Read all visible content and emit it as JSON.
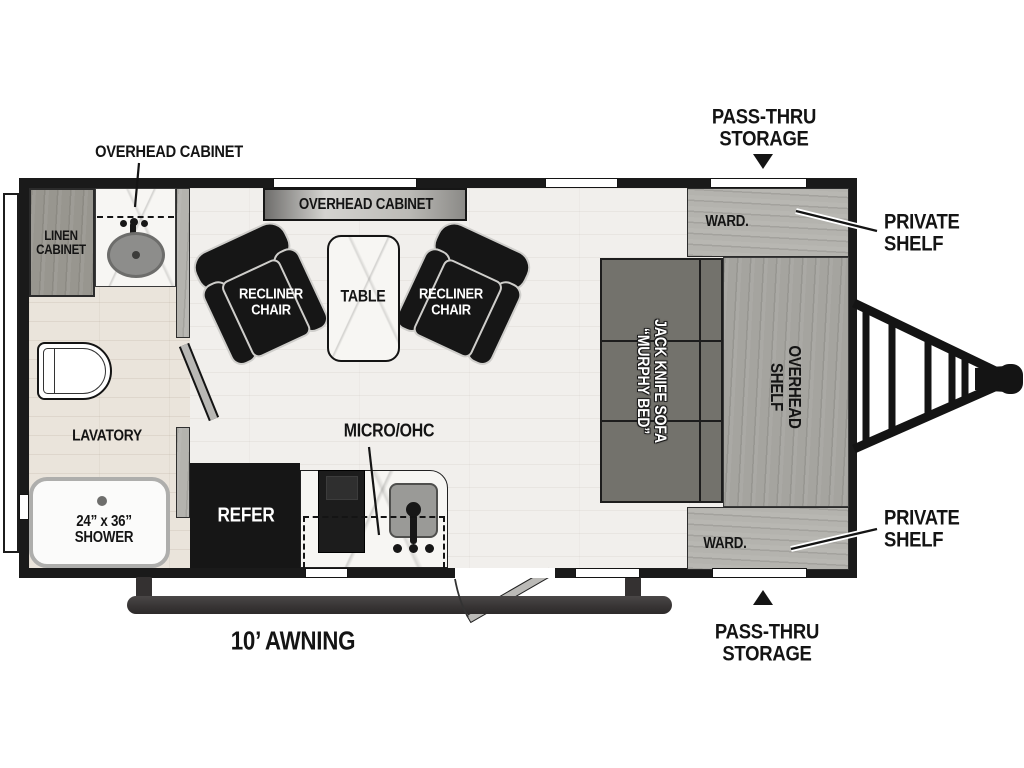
{
  "title": "Travel trailer floorplan",
  "colors": {
    "wall": "#1a1a1a",
    "floor-main": "#f1efec",
    "floor-bath": "#eae4db",
    "wood-light": "#b4b3ae",
    "wood-mid": "#a5a49f",
    "wood-dark": "#98968f",
    "black-furn": "#161616",
    "sofa": "#73726c",
    "marble": "#f7f6f3",
    "awning": "#3e3b3b"
  },
  "labels": {
    "overhead_cabinet_callout": "OVERHEAD CABINET",
    "pass_thru_top": {
      "line1": "PASS-THRU",
      "line2": "STORAGE"
    },
    "private_shelf_top": {
      "line1": "PRIVATE",
      "line2": "SHELF"
    },
    "linen_cabinet": {
      "line1": "LINEN",
      "line2": "CABINET"
    },
    "overhead_cabinet_bar": "OVERHEAD CABINET",
    "recliner_left": {
      "line1": "RECLINER",
      "line2": "CHAIR"
    },
    "table": "TABLE",
    "recliner_right": {
      "line1": "RECLINER",
      "line2": "CHAIR"
    },
    "ward_top": "WARD.",
    "sofa": {
      "line1": "JACK KNIFE SOFA",
      "line2": "“MURPHY BED”"
    },
    "overhead_shelf": {
      "line1": "OVERHEAD",
      "line2": "SHELF"
    },
    "lavatory": "LAVATORY",
    "micro_ohc": "MICRO/OHC",
    "refer": "REFER",
    "shower": {
      "line1": "24” x 36”",
      "line2": "SHOWER"
    },
    "ward_bottom": "WARD.",
    "private_shelf_bottom": {
      "line1": "PRIVATE",
      "line2": "SHELF"
    },
    "pass_thru_bottom": {
      "line1": "PASS-THRU",
      "line2": "STORAGE"
    },
    "awning": "10’ AWNING"
  }
}
